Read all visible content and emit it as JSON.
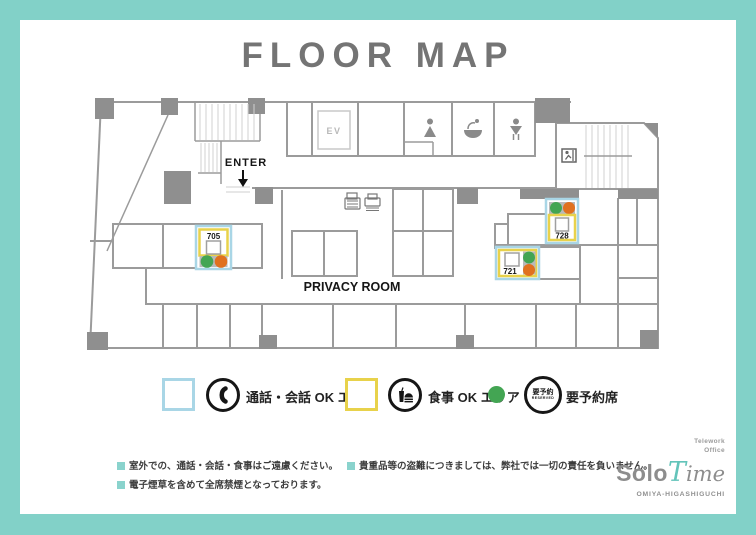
{
  "page": {
    "title": "FLOOR MAP"
  },
  "plan": {
    "enter_label": "ENTER",
    "elevator_label": "EV",
    "privacy_room_label": "PRIVACY ROOM",
    "rooms": [
      {
        "id": "705"
      },
      {
        "id": "721"
      },
      {
        "id": "728"
      }
    ]
  },
  "legend": {
    "call_area": {
      "label": "通話・会話 OK エリア",
      "color": "#a9d6e6"
    },
    "food_area": {
      "label": "食事 OK エリア",
      "color": "#e8d24b"
    },
    "reserved": {
      "label": "要予約席",
      "dot_color": "#43a553",
      "badge_line1": "要予約",
      "badge_line2": "RESERVED"
    }
  },
  "notes": {
    "bullet_color": "#8ad3cd",
    "items": [
      "室外での、通話・会話・食事はご遠慮ください。",
      "電子煙草を含めて全席禁煙となっております。",
      "貴重品等の盗難につきましては、弊社では一切の責任を負いません。"
    ]
  },
  "logo": {
    "tagline_line1": "Telework",
    "tagline_line2": "Office",
    "name_part1": "Solo",
    "name_part2_initial": "T",
    "name_part2_rest": "ime",
    "location": "OMIYA-HIGASHIGUCHI"
  },
  "seat_colors": {
    "green": "#43a553",
    "orange": "#e0711f"
  },
  "frame_color": "#82d1c8"
}
